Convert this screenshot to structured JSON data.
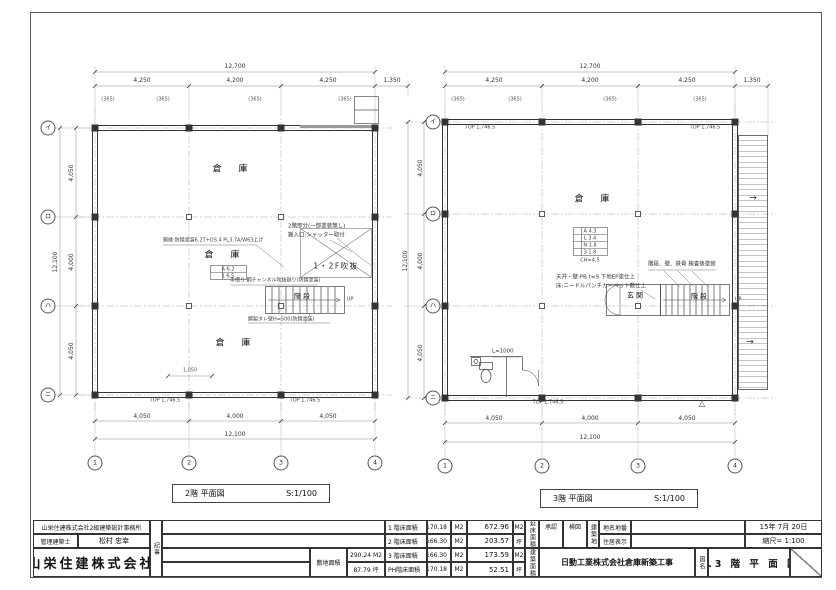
{
  "plans": {
    "p2f": {
      "title": "2階  平面図",
      "scale": "S:1/100"
    },
    "p3f": {
      "title": "3階  平面図",
      "scale": "S:1/100"
    }
  },
  "labels": [
    {
      "n": "dim-top-overall-2f",
      "t": "12,700",
      "x": 235,
      "y": 67,
      "c": "dim"
    },
    {
      "n": "dim-top-bay-2f",
      "t": "4,250",
      "x": 142,
      "y": 81,
      "c": "dim"
    },
    {
      "n": "dim-top-bay-2f",
      "t": "4,200",
      "x": 235,
      "y": 81,
      "c": "dim"
    },
    {
      "n": "dim-top-bay-2f",
      "t": "4,250",
      "x": 328,
      "y": 81,
      "c": "dim"
    },
    {
      "n": "dim-top-ext-2f",
      "t": "1,350",
      "x": 392,
      "y": 81,
      "c": "dim"
    },
    {
      "n": "wall-offset-2f",
      "t": "(365)",
      "x": 108,
      "y": 100,
      "c": "off"
    },
    {
      "n": "wall-offset-2f",
      "t": "(365)",
      "x": 163,
      "y": 100,
      "c": "off"
    },
    {
      "n": "wall-offset-2f",
      "t": "(365)",
      "x": 255,
      "y": 100,
      "c": "off"
    },
    {
      "n": "wall-offset-2f",
      "t": "(365)",
      "x": 345,
      "y": 100,
      "c": "off"
    },
    {
      "n": "dim-left-overall-2f",
      "t": "12,100",
      "x": 56,
      "y": 262,
      "r": -90,
      "c": "dim"
    },
    {
      "n": "dim-left-bay-2f",
      "t": "4,050",
      "x": 72,
      "y": 173,
      "r": -90,
      "c": "dim"
    },
    {
      "n": "dim-left-bay-2f",
      "t": "4,000",
      "x": 72,
      "y": 262,
      "r": -90,
      "c": "dim"
    },
    {
      "n": "dim-left-bay-2f",
      "t": "4,050",
      "x": 72,
      "y": 351,
      "r": -90,
      "c": "dim"
    },
    {
      "n": "dim-bottom-bay-2f",
      "t": "4,050",
      "x": 142,
      "y": 417,
      "c": "dim"
    },
    {
      "n": "dim-bottom-bay-2f",
      "t": "4,000",
      "x": 235,
      "y": 417,
      "c": "dim"
    },
    {
      "n": "dim-bottom-bay-2f",
      "t": "4,050",
      "x": 328,
      "y": 417,
      "c": "dim"
    },
    {
      "n": "dim-bottom-overall-2f",
      "t": "12,100",
      "x": 235,
      "y": 435,
      "c": "dim"
    },
    {
      "n": "grid-bubble",
      "t": "イ",
      "x": 48,
      "y": 128,
      "c": "bubble"
    },
    {
      "n": "grid-bubble",
      "t": "ロ",
      "x": 48,
      "y": 217,
      "c": "bubble"
    },
    {
      "n": "grid-bubble",
      "t": "ハ",
      "x": 48,
      "y": 306,
      "c": "bubble"
    },
    {
      "n": "grid-bubble",
      "t": "ニ",
      "x": 48,
      "y": 395,
      "c": "bubble"
    },
    {
      "n": "grid-bubble",
      "t": "1",
      "x": 95,
      "y": 463,
      "c": "bubble"
    },
    {
      "n": "grid-bubble",
      "t": "2",
      "x": 189,
      "y": 463,
      "c": "bubble"
    },
    {
      "n": "grid-bubble",
      "t": "3",
      "x": 281,
      "y": 463,
      "c": "bubble"
    },
    {
      "n": "grid-bubble",
      "t": "4",
      "x": 375,
      "y": 463,
      "c": "bubble"
    },
    {
      "n": "room-label-warehouse",
      "t": "倉 庫",
      "x": 230,
      "y": 170,
      "c": "room"
    },
    {
      "n": "room-label-warehouse",
      "t": "倉 庫",
      "x": 222,
      "y": 256,
      "c": "room"
    },
    {
      "n": "room-label-warehouse",
      "t": "倉 庫",
      "x": 233,
      "y": 344,
      "c": "room"
    },
    {
      "n": "finish-tag-2f",
      "t": "A 6.2",
      "x": 228,
      "y": 270,
      "c": "tiny"
    },
    {
      "n": "finish-tag-2f",
      "t": "1 6.5",
      "x": 228,
      "y": 277,
      "c": "tiny"
    },
    {
      "n": "void-label",
      "t": "1・2F吹抜",
      "x": 336,
      "y": 266,
      "c": "voidlbl"
    },
    {
      "n": "stair-label",
      "t": "階段",
      "x": 303,
      "y": 297,
      "c": "roomsm"
    },
    {
      "n": "stair-up-label",
      "t": "UP",
      "x": 350,
      "y": 300,
      "c": "tiny"
    },
    {
      "n": "note-2f-paint",
      "t": "2階部分(一部塗装無し)",
      "x": 288,
      "y": 227,
      "c": "note la"
    },
    {
      "n": "note-2f-shutter",
      "t": "搬入口:シャッター取付",
      "x": 288,
      "y": 236,
      "c": "note la"
    },
    {
      "n": "note-2f-girt",
      "t": "胴縁:防錆塗装6.2T+DS.4 PL3.7A/W63上げ",
      "x": 163,
      "y": 241,
      "c": "tiny la"
    },
    {
      "n": "note-2f-handrail",
      "t": "手摺り:鋼チャンネル吹抜廻り(防錆塗装)",
      "x": 230,
      "y": 281,
      "c": "tiny la"
    },
    {
      "n": "note-2f-wall",
      "t": "鋼製タレ壁H=500(防錆塗装)",
      "x": 248,
      "y": 320,
      "c": "tiny la"
    },
    {
      "n": "beam-tag",
      "t": "TOP 1,746.5",
      "x": 165,
      "y": 401,
      "c": "tiny"
    },
    {
      "n": "beam-tag",
      "t": "TOP 1,746.5",
      "x": 305,
      "y": 401,
      "c": "tiny"
    },
    {
      "n": "dim-small-2f",
      "t": "1,050",
      "x": 190,
      "y": 371,
      "c": "off"
    },
    {
      "n": "dim-top-overall-3f",
      "t": "12,700",
      "x": 590,
      "y": 67,
      "c": "dim"
    },
    {
      "n": "dim-top-bay-3f",
      "t": "4,250",
      "x": 494,
      "y": 81,
      "c": "dim"
    },
    {
      "n": "dim-top-bay-3f",
      "t": "4,200",
      "x": 590,
      "y": 81,
      "c": "dim"
    },
    {
      "n": "dim-top-bay-3f",
      "t": "4,250",
      "x": 687,
      "y": 81,
      "c": "dim"
    },
    {
      "n": "dim-top-ext-3f",
      "t": "1,350",
      "x": 752,
      "y": 81,
      "c": "dim"
    },
    {
      "n": "wall-offset-3f",
      "t": "(365)",
      "x": 458,
      "y": 100,
      "c": "off"
    },
    {
      "n": "wall-offset-3f",
      "t": "(365)",
      "x": 515,
      "y": 100,
      "c": "off"
    },
    {
      "n": "wall-offset-3f",
      "t": "(365)",
      "x": 610,
      "y": 100,
      "c": "off"
    },
    {
      "n": "wall-offset-3f",
      "t": "(365)",
      "x": 700,
      "y": 100,
      "c": "off"
    },
    {
      "n": "dim-left-overall-3f",
      "t": "12,100",
      "x": 406,
      "y": 261,
      "r": -90,
      "c": "dim"
    },
    {
      "n": "dim-left-bay-3f",
      "t": "4,050",
      "x": 421,
      "y": 168,
      "r": -90,
      "c": "dim"
    },
    {
      "n": "dim-left-bay-3f",
      "t": "4,000",
      "x": 421,
      "y": 261,
      "r": -90,
      "c": "dim"
    },
    {
      "n": "dim-left-bay-3f",
      "t": "4,050",
      "x": 421,
      "y": 353,
      "r": -90,
      "c": "dim"
    },
    {
      "n": "dim-bottom-bay-3f",
      "t": "4,050",
      "x": 494,
      "y": 419,
      "c": "dim"
    },
    {
      "n": "dim-bottom-bay-3f",
      "t": "4,000",
      "x": 590,
      "y": 419,
      "c": "dim"
    },
    {
      "n": "dim-bottom-bay-3f",
      "t": "4,050",
      "x": 687,
      "y": 419,
      "c": "dim"
    },
    {
      "n": "dim-bottom-overall-3f",
      "t": "12,100",
      "x": 590,
      "y": 438,
      "c": "dim"
    },
    {
      "n": "grid-bubble",
      "t": "イ",
      "x": 433,
      "y": 122,
      "c": "bubble"
    },
    {
      "n": "grid-bubble",
      "t": "ロ",
      "x": 433,
      "y": 214,
      "c": "bubble"
    },
    {
      "n": "grid-bubble",
      "t": "ハ",
      "x": 433,
      "y": 306,
      "c": "bubble"
    },
    {
      "n": "grid-bubble",
      "t": "ニ",
      "x": 433,
      "y": 398,
      "c": "bubble"
    },
    {
      "n": "grid-bubble",
      "t": "1",
      "x": 445,
      "y": 466,
      "c": "bubble"
    },
    {
      "n": "grid-bubble",
      "t": "2",
      "x": 542,
      "y": 466,
      "c": "bubble"
    },
    {
      "n": "grid-bubble",
      "t": "3",
      "x": 638,
      "y": 466,
      "c": "bubble"
    },
    {
      "n": "grid-bubble",
      "t": "4",
      "x": 735,
      "y": 466,
      "c": "bubble"
    },
    {
      "n": "room-label-warehouse",
      "t": "倉 庫",
      "x": 592,
      "y": 200,
      "c": "room"
    },
    {
      "n": "finish-tag-3f",
      "t": "A 4.3",
      "x": 590,
      "y": 232,
      "c": "tiny"
    },
    {
      "n": "finish-tag-3f",
      "t": "L 3.4",
      "x": 590,
      "y": 239,
      "c": "tiny"
    },
    {
      "n": "finish-tag-3f",
      "t": "N 1.8",
      "x": 590,
      "y": 246,
      "c": "tiny"
    },
    {
      "n": "finish-tag-3f",
      "t": "3 1.8",
      "x": 590,
      "y": 253,
      "c": "tiny"
    },
    {
      "n": "finish-tag-3f",
      "t": "CH=4.5",
      "x": 590,
      "y": 261,
      "c": "tiny"
    },
    {
      "n": "note-3f-ceiling",
      "t": "天井・壁:PB t=9 下地EP塗仕上",
      "x": 556,
      "y": 278,
      "c": "note la"
    },
    {
      "n": "note-3f-floor",
      "t": "床:ニードルパンチカーペット敷仕上",
      "x": 556,
      "y": 287,
      "c": "note la"
    },
    {
      "n": "note-3f-stair-paint",
      "t": "階段、壁、鉄骨  検査後塗装",
      "x": 648,
      "y": 265,
      "c": "note la"
    },
    {
      "n": "room-label-entrance",
      "t": "玄関",
      "x": 636,
      "y": 296,
      "c": "roomsm"
    },
    {
      "n": "stair-label",
      "t": "階段",
      "x": 700,
      "y": 297,
      "c": "roomsm"
    },
    {
      "n": "stair-up-label",
      "t": "UP",
      "x": 738,
      "y": 300,
      "c": "tiny"
    },
    {
      "n": "note-3f-wc",
      "t": "L=1000",
      "x": 492,
      "y": 352,
      "c": "note la"
    },
    {
      "n": "exterior-stair-arrow",
      "t": "→",
      "x": 753,
      "y": 199,
      "c": "arrow"
    },
    {
      "n": "exterior-stair-arrow",
      "t": "→",
      "x": 750,
      "y": 343,
      "c": "arrow"
    },
    {
      "n": "level-marker",
      "t": "△",
      "x": 702,
      "y": 404,
      "c": "tri"
    },
    {
      "n": "beam-tag",
      "t": "TOP 1,746.5",
      "x": 480,
      "y": 128,
      "c": "tiny"
    },
    {
      "n": "beam-tag",
      "t": "TOP 1,746.5",
      "x": 705,
      "y": 128,
      "c": "tiny"
    },
    {
      "n": "beam-tag",
      "t": "TOP 1,746.5",
      "x": 548,
      "y": 403,
      "c": "tiny"
    }
  ],
  "tb_cells": [
    {
      "n": "tb-design-office",
      "t": "山栄住建株式会社2級建築設計事務所",
      "x": 33,
      "y": 520,
      "w": 117,
      "h": 14,
      "c": "t6"
    },
    {
      "n": "tb-architect-label",
      "t": "管理建築士",
      "x": 33,
      "y": 534,
      "w": 45,
      "h": 14,
      "c": "t6"
    },
    {
      "n": "tb-architect-name",
      "t": "松村 忠幸",
      "x": 78,
      "y": 534,
      "w": 72,
      "h": 14,
      "c": "t7"
    },
    {
      "n": "tb-company-name",
      "t": "山栄住建株式会社",
      "x": 33,
      "y": 548,
      "w": 117,
      "h": 29,
      "c": "big"
    },
    {
      "n": "tb-notes-label",
      "t": "記事",
      "x": 150,
      "y": 520,
      "w": 12,
      "h": 57,
      "c": "vert t6"
    },
    {
      "n": "tb-notes-row1",
      "t": "",
      "x": 162,
      "y": 520,
      "w": 223,
      "h": 14,
      "c": ""
    },
    {
      "n": "tb-notes-row2",
      "t": "",
      "x": 162,
      "y": 534,
      "w": 223,
      "h": 14,
      "c": ""
    },
    {
      "n": "tb-notes-row3",
      "t": "",
      "x": 162,
      "y": 548,
      "w": 148,
      "h": 14,
      "c": ""
    },
    {
      "n": "tb-notes-row4",
      "t": "",
      "x": 162,
      "y": 562,
      "w": 148,
      "h": 15,
      "c": ""
    },
    {
      "n": "tb-site-area-label",
      "t": "敷地面積",
      "x": 310,
      "y": 548,
      "w": 37,
      "h": 29,
      "c": "t6"
    },
    {
      "n": "tb-site-area-m2",
      "t": "290.24 M2",
      "x": 347,
      "y": 548,
      "w": 38,
      "h": 14,
      "c": "t6"
    },
    {
      "n": "tb-site-area-tsubo",
      "t": "87.79 坪",
      "x": 347,
      "y": 562,
      "w": 38,
      "h": 15,
      "c": "t6"
    },
    {
      "n": "tb-1f-area-label",
      "t": "1 階床面積",
      "x": 385,
      "y": 520,
      "w": 42,
      "h": 14,
      "c": "t6 l"
    },
    {
      "n": "tb-2f-area-label",
      "t": "2 階床面積",
      "x": 385,
      "y": 534,
      "w": 42,
      "h": 14,
      "c": "t6 l"
    },
    {
      "n": "tb-3f-area-label",
      "t": "3 階床面積",
      "x": 385,
      "y": 548,
      "w": 42,
      "h": 14,
      "c": "t6 l"
    },
    {
      "n": "tb-ph-area-label",
      "t": "PH階床面積",
      "x": 385,
      "y": 562,
      "w": 42,
      "h": 15,
      "c": "t6 l"
    },
    {
      "n": "tb-1f-area-value",
      "t": "170.18",
      "x": 427,
      "y": 520,
      "w": 24,
      "h": 14,
      "c": "t6 r"
    },
    {
      "n": "tb-2f-area-value",
      "t": "166.30",
      "x": 427,
      "y": 534,
      "w": 24,
      "h": 14,
      "c": "t6 r"
    },
    {
      "n": "tb-3f-area-value",
      "t": "166.30",
      "x": 427,
      "y": 548,
      "w": 24,
      "h": 14,
      "c": "t6 r"
    },
    {
      "n": "tb-ph-area-value",
      "t": "170.18",
      "x": 427,
      "y": 562,
      "w": 24,
      "h": 15,
      "c": "t6 r"
    },
    {
      "n": "tb-1f-area-unit",
      "t": "M2",
      "x": 451,
      "y": 520,
      "w": 16,
      "h": 14,
      "c": "t6"
    },
    {
      "n": "tb-2f-area-unit",
      "t": "M2",
      "x": 451,
      "y": 534,
      "w": 16,
      "h": 14,
      "c": "t6"
    },
    {
      "n": "tb-3f-area-unit",
      "t": "M2",
      "x": 451,
      "y": 548,
      "w": 16,
      "h": 14,
      "c": "t6"
    },
    {
      "n": "tb-ph-area-unit",
      "t": "M2",
      "x": 451,
      "y": 562,
      "w": 16,
      "h": 15,
      "c": "t6"
    },
    {
      "n": "tb-total-area-m2",
      "t": "672.96",
      "x": 467,
      "y": 520,
      "w": 46,
      "h": 14,
      "c": "t7 r"
    },
    {
      "n": "tb-total-area-tsubo",
      "t": "203.57",
      "x": 467,
      "y": 534,
      "w": 46,
      "h": 14,
      "c": "t7 r"
    },
    {
      "n": "tb-building-area-m2",
      "t": "173.59",
      "x": 467,
      "y": 548,
      "w": 46,
      "h": 14,
      "c": "t7 r"
    },
    {
      "n": "tb-building-area-tsubo",
      "t": "52.51",
      "x": 467,
      "y": 562,
      "w": 46,
      "h": 15,
      "c": "t7 r"
    },
    {
      "n": "tb-total-unit-m2",
      "t": "M2",
      "x": 513,
      "y": 520,
      "w": 12,
      "h": 14,
      "c": "t6"
    },
    {
      "n": "tb-total-unit-tsubo",
      "t": "坪",
      "x": 513,
      "y": 534,
      "w": 12,
      "h": 14,
      "c": "t6"
    },
    {
      "n": "tb-building-unit-m2",
      "t": "M2",
      "x": 513,
      "y": 548,
      "w": 12,
      "h": 14,
      "c": "t6"
    },
    {
      "n": "tb-building-unit-tsubo",
      "t": "坪",
      "x": 513,
      "y": 562,
      "w": 12,
      "h": 15,
      "c": "t6"
    },
    {
      "n": "tb-total-area-label",
      "t": "延床面積",
      "x": 525,
      "y": 520,
      "w": 14,
      "h": 28,
      "c": "vert t6"
    },
    {
      "n": "tb-building-area-label",
      "t": "建築面積",
      "x": 525,
      "y": 548,
      "w": 14,
      "h": 29,
      "c": "vert t6"
    },
    {
      "n": "tb-approval-label",
      "t": "承認",
      "x": 539,
      "y": 520,
      "w": 24,
      "h": 28,
      "c": "t6 top"
    },
    {
      "n": "tb-check-label",
      "t": "検図",
      "x": 563,
      "y": 520,
      "w": 24,
      "h": 28,
      "c": "t6 top"
    },
    {
      "n": "tb-buildsite-label",
      "t": "建築地",
      "x": 587,
      "y": 520,
      "w": 12,
      "h": 28,
      "c": "vert t6"
    },
    {
      "n": "tb-lot-label",
      "t": "地名地番",
      "x": 599,
      "y": 520,
      "w": 32,
      "h": 14,
      "c": "t6"
    },
    {
      "n": "tb-address-label",
      "t": "住居表示",
      "x": 599,
      "y": 534,
      "w": 32,
      "h": 14,
      "c": "t6"
    },
    {
      "n": "tb-lot-value",
      "t": "",
      "x": 631,
      "y": 520,
      "w": 114,
      "h": 14,
      "c": ""
    },
    {
      "n": "tb-address-value",
      "t": "",
      "x": 631,
      "y": 534,
      "w": 114,
      "h": 14,
      "c": ""
    },
    {
      "n": "tb-date",
      "t": "15年 7月 20日",
      "x": 745,
      "y": 520,
      "w": 77,
      "h": 14,
      "c": "t7"
    },
    {
      "n": "tb-scale",
      "t": "縮尺= 1:100",
      "x": 745,
      "y": 534,
      "w": 77,
      "h": 14,
      "c": "t7"
    },
    {
      "n": "tb-project-name",
      "t": "日動工業株式会社倉庫新築工事",
      "x": 539,
      "y": 548,
      "w": 156,
      "h": 29,
      "c": "t8 bold"
    },
    {
      "n": "tb-dwgname-label",
      "t": "図名",
      "x": 695,
      "y": 548,
      "w": 13,
      "h": 29,
      "c": "vert t6"
    },
    {
      "n": "tb-dwg-title",
      "t": "2.3 階 平 面 図",
      "x": 708,
      "y": 548,
      "w": 82,
      "h": 29,
      "c": "t9 bold sp"
    },
    {
      "n": "tb-dwg-no",
      "t": "",
      "x": 790,
      "y": 548,
      "w": 32,
      "h": 29,
      "c": "slash"
    }
  ]
}
